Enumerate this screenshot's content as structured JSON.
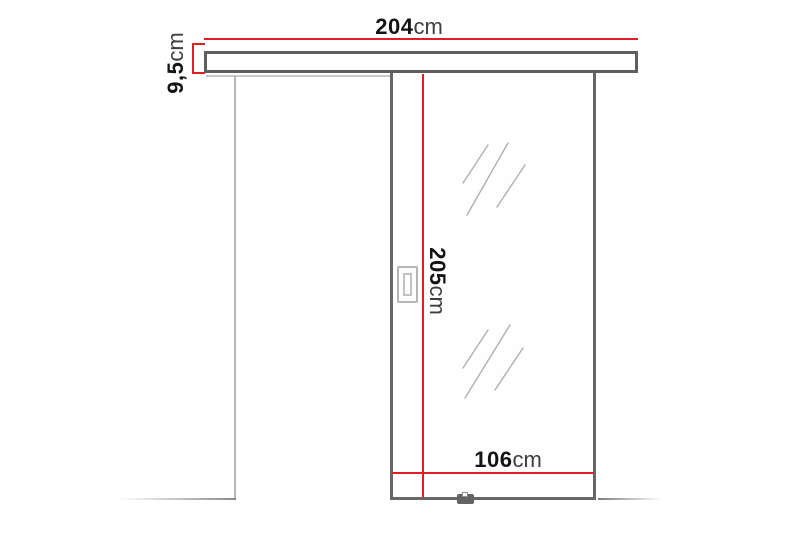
{
  "diagram": {
    "title": "sliding-door-dimension-diagram",
    "colors": {
      "dimension_red": "#e01e25",
      "outline_dark": "#666666",
      "outline_light": "#b5b5b5",
      "floor_gray": "#8a8a8a",
      "shine_gray": "#a3a3a3",
      "text_black": "#141414",
      "text_unit": "#3d3d3d"
    },
    "dimensions": {
      "rail_width": {
        "value": "204",
        "unit": "cm"
      },
      "rail_height": {
        "value": "9,5",
        "unit": "cm"
      },
      "door_height": {
        "value": "205",
        "unit": "cm"
      },
      "door_width": {
        "value": "106",
        "unit": "cm"
      }
    }
  }
}
